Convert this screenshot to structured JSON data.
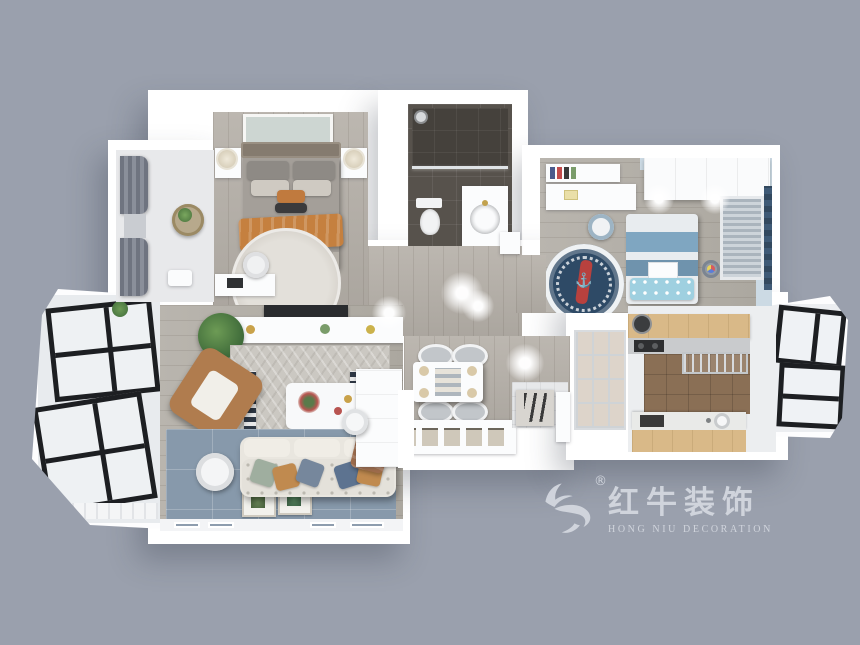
{
  "watermark": {
    "brand_cn": "红牛装饰",
    "brand_en": "HONG NIU DECORATION",
    "registered": "®",
    "color": "#d5d9e1"
  },
  "icons": {
    "anchor": "⚓",
    "bull": "bull-swoosh-logo"
  },
  "palette": {
    "background": "#9aa0ad",
    "wall": "#ffffff",
    "wood_floor": "#b4afa8",
    "master_blanket_orange": "#c5803f",
    "bathroom_tile": "#57524c",
    "kids_blue": "#7fa6c1",
    "kids_rug_navy": "#2e4a66",
    "living_carpet": "#8799ab",
    "armchair_tan": "#b07c4e",
    "kitchen_wood": "#d9b988",
    "kitchen_floor": "#8a6f55",
    "window_frame": "#1d1f22"
  },
  "rooms": [
    {
      "id": "master-bedroom"
    },
    {
      "id": "master-balcony"
    },
    {
      "id": "bathroom"
    },
    {
      "id": "kids-bedroom"
    },
    {
      "id": "hallway"
    },
    {
      "id": "dining-area"
    },
    {
      "id": "entry"
    },
    {
      "id": "living-room"
    },
    {
      "id": "living-balcony"
    },
    {
      "id": "kitchen"
    },
    {
      "id": "kitchen-balcony"
    }
  ]
}
